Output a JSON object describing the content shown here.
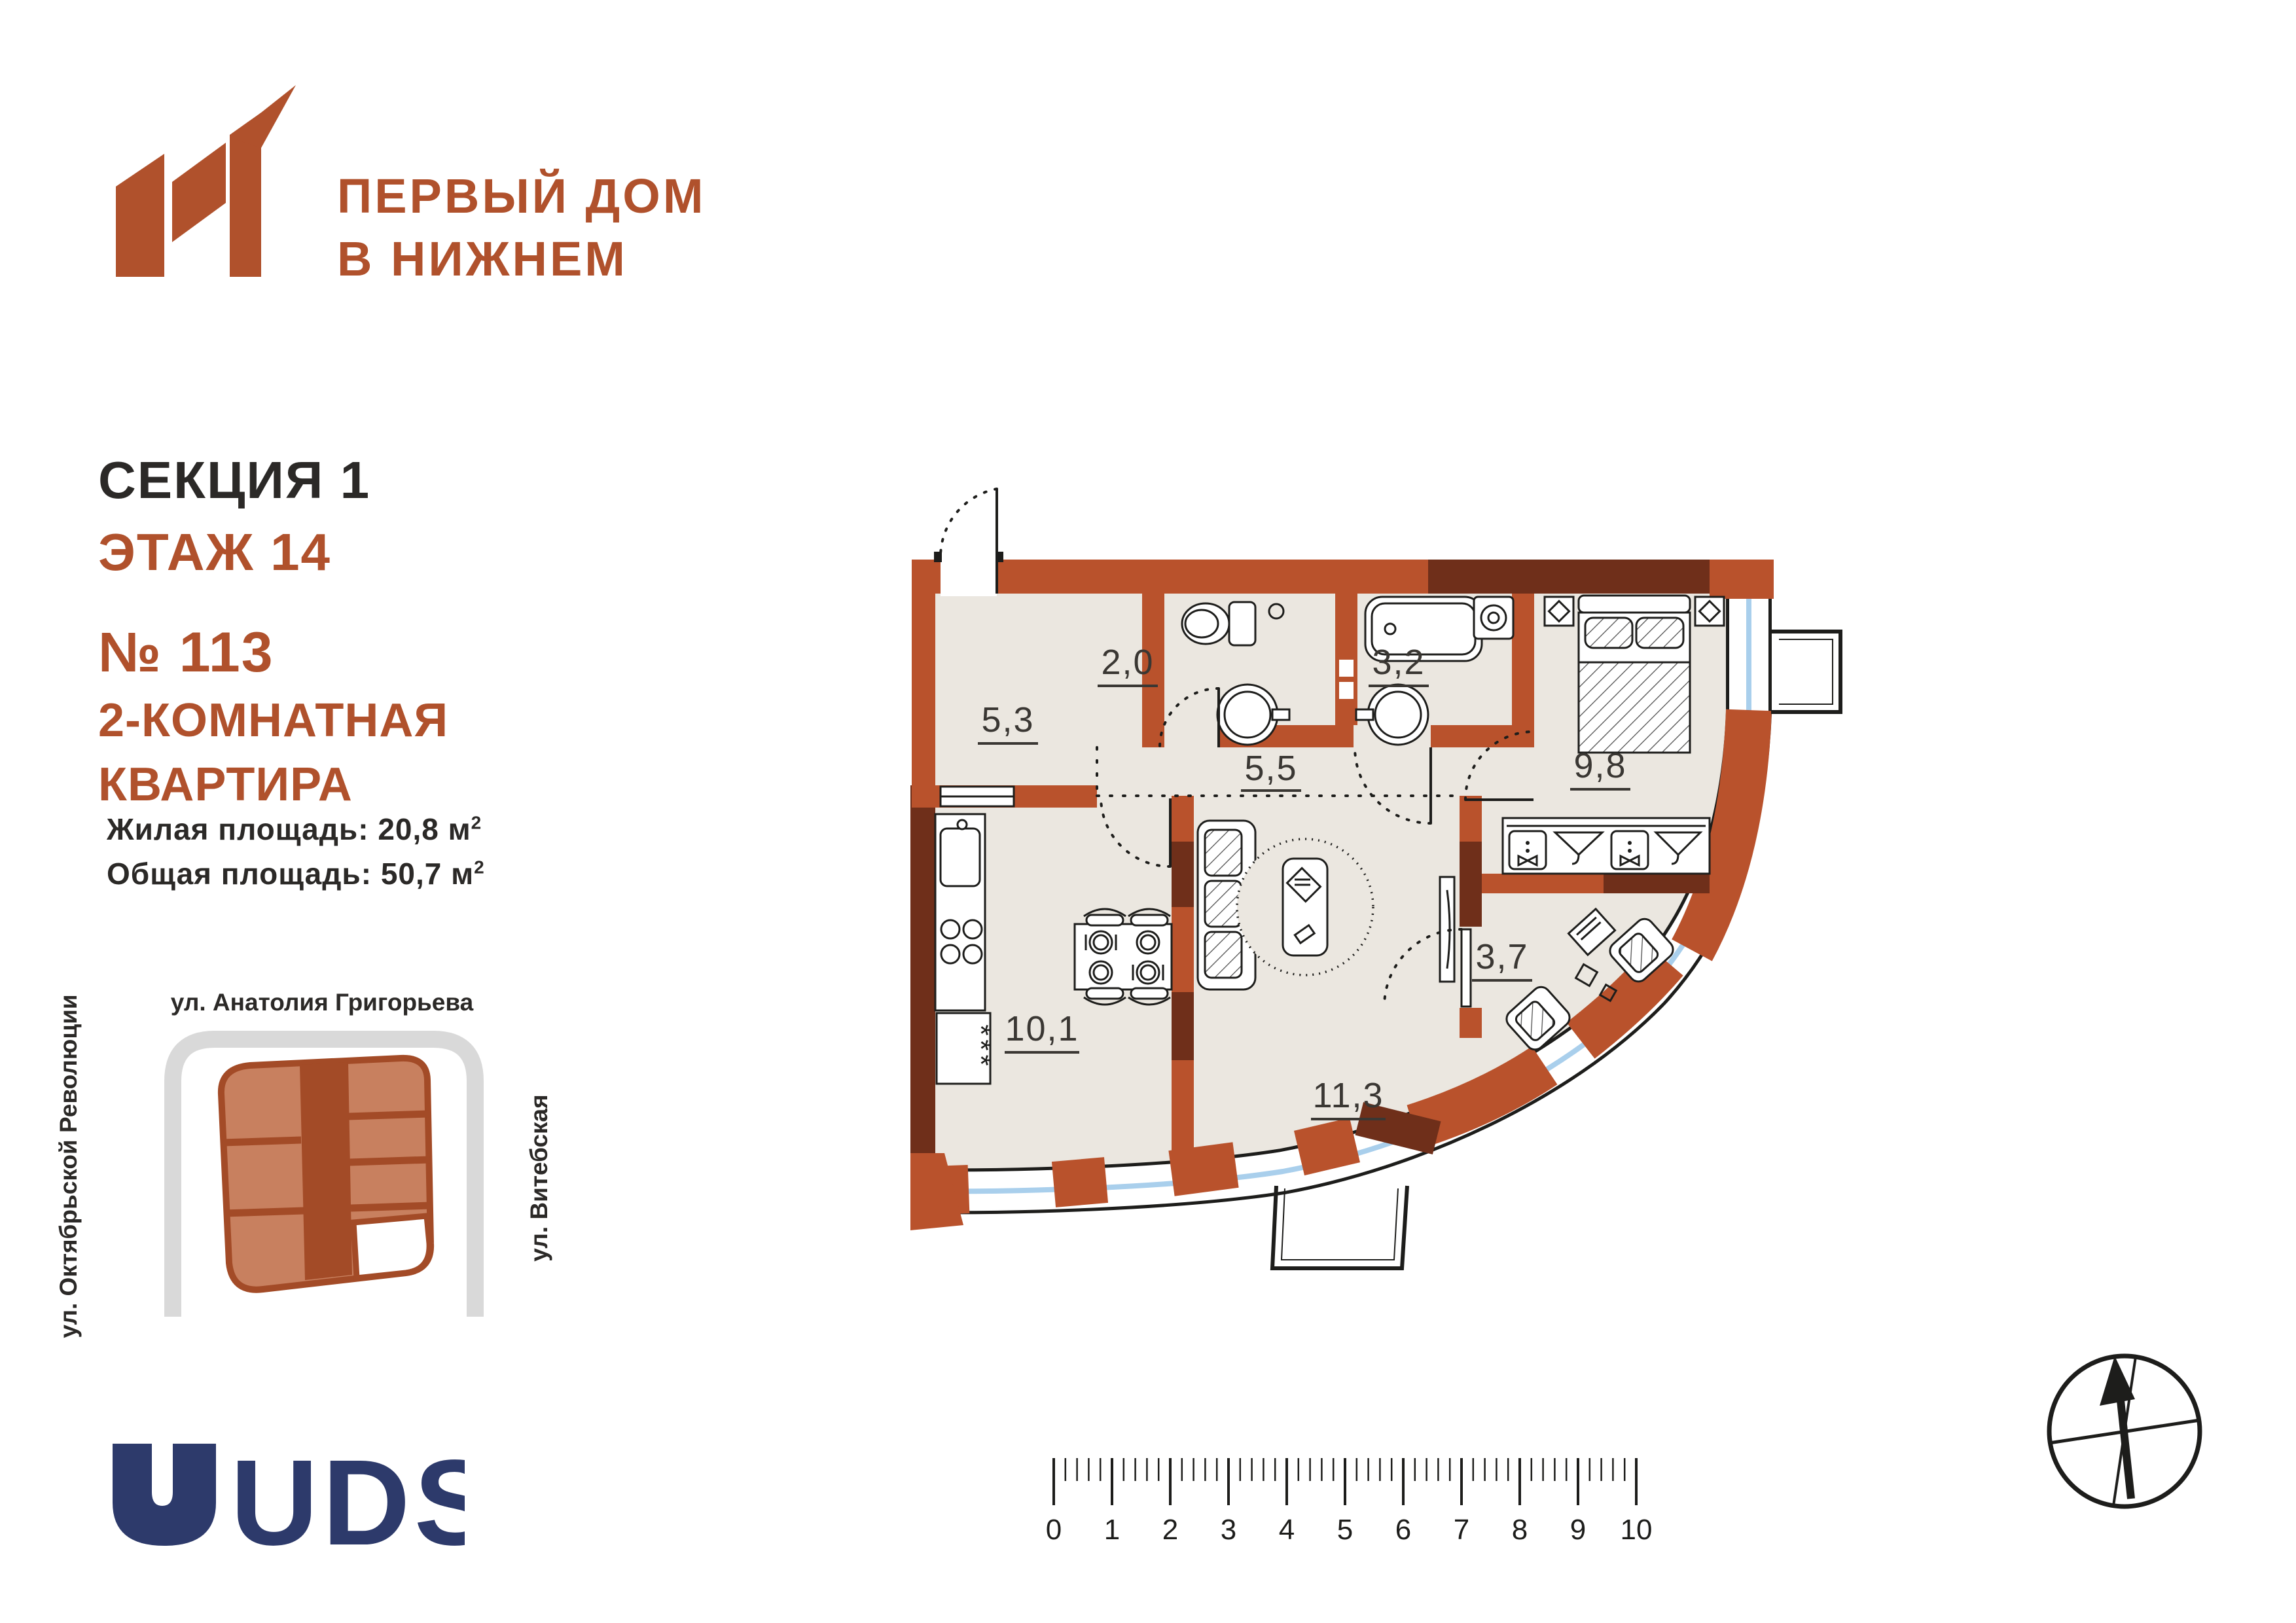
{
  "brand": {
    "mark": "N1",
    "line1": "ПЕРВЫЙ ДОМ",
    "line2": "В НИЖНЕМ",
    "color": "#b0512c"
  },
  "header": {
    "section_label": "СЕКЦИЯ",
    "section_number": "1",
    "floor_label": "ЭТАЖ",
    "floor_number": "14",
    "apt_no_label": "№",
    "apt_no": "113",
    "apt_type_line1": "2-КОМНАТНАЯ",
    "apt_type_line2": "КВАРТИРА"
  },
  "areas": {
    "living_label": "Жилая площадь:",
    "living_value": "20,8",
    "total_label": "Общая площадь:",
    "total_value": "50,7",
    "unit": "м",
    "unit_sup": "2"
  },
  "site_plan": {
    "street_top": "ул. Анатолия Григорьева",
    "street_left": "ул. Октябрьской Революции",
    "street_right": "ул. Витебская",
    "street_color": "#d9d9d9",
    "building_fill": "#c8805f",
    "building_core": "#a34b27",
    "highlight_fill": "#ffffff"
  },
  "developer": {
    "name": "UDS",
    "color": "#2d3a6b"
  },
  "plan": {
    "wall_color": "#b9522c",
    "wall_dark": "#6f2f1a",
    "floor_color": "#ebe7e0",
    "glazing_color": "#a9cfec",
    "rooms": [
      {
        "name": "hallway",
        "area": "5,3"
      },
      {
        "name": "wc",
        "area": "2,0"
      },
      {
        "name": "bathroom",
        "area": "3,2"
      },
      {
        "name": "corridor",
        "area": "5,5"
      },
      {
        "name": "bedroom",
        "area": "9,8"
      },
      {
        "name": "kitchen",
        "area": "10,1"
      },
      {
        "name": "living-room",
        "area": "11,3"
      },
      {
        "name": "cabinet",
        "area": "3,7"
      }
    ],
    "fridge_marks": "***"
  },
  "ruler": {
    "labels": [
      "0",
      "1",
      "2",
      "3",
      "4",
      "5",
      "6",
      "7",
      "8",
      "9",
      "10"
    ]
  }
}
